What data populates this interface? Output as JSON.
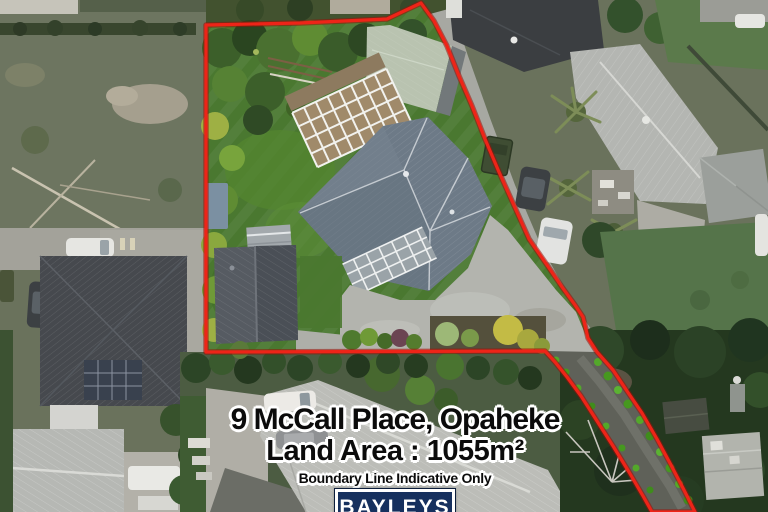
{
  "overlay": {
    "address": "9 McCall Place, Opaheke",
    "land_area": "Land Area : 1055m²",
    "disclaimer": "Boundary Line Indicative Only",
    "brand": "BAYLEYS"
  },
  "boundary": {
    "stroke_color": "#ee2418",
    "underlay_color": "#9a1008",
    "points": "206,25 300,23 387,19 421,3 434,21 447,46 459,76 472,106 485,139 499,172 512,201 529,239 547,265 562,287 575,305 583,317 588,338 597,352 613,370 627,391 642,413 657,439 671,465 684,490 695,512 652,512 643,496 629,472 613,446 597,421 581,396 567,377 555,362 545,351 206,352"
  },
  "brand_colors": {
    "bayleys_navy": "#16305e",
    "boundary_red": "#ee2418",
    "text_black": "#0b0b0b",
    "halo_white": "#ffffff"
  }
}
